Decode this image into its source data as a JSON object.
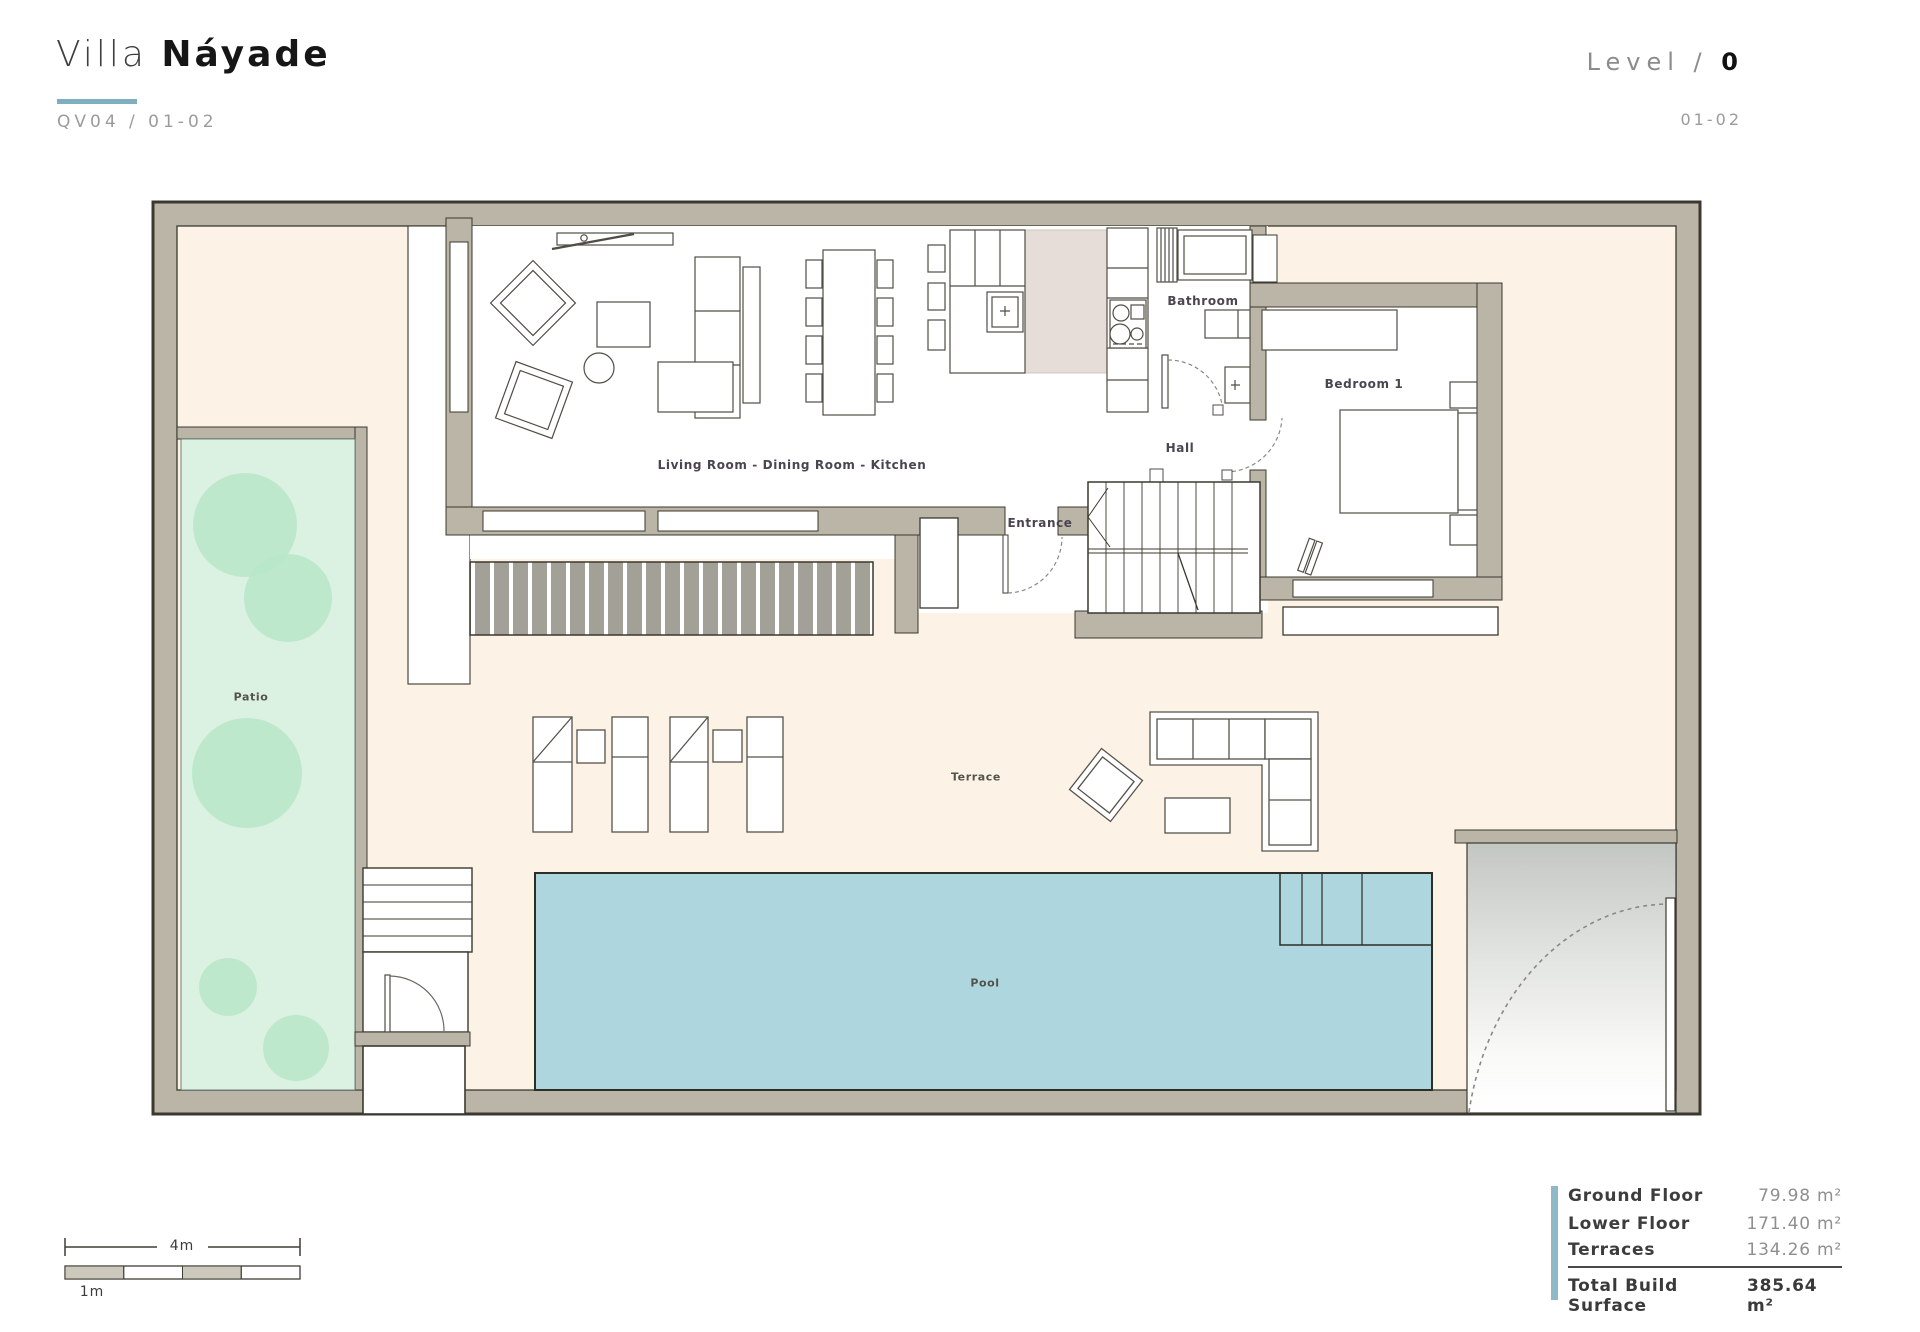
{
  "header": {
    "title_light": "Villa",
    "title_bold": "Náyade",
    "project_code": "QV04 / 01-02",
    "level_label": "Level /",
    "level_value": "0",
    "sheet_code": "01-02"
  },
  "plan": {
    "rooms": {
      "living": "Living Room - Dining Room - Kitchen",
      "bathroom": "Bathroom",
      "hall": "Hall",
      "bedroom": "Bedroom 1",
      "entrance": "Entrance",
      "patio": "Patio",
      "terrace": "Terrace",
      "pool": "Pool"
    }
  },
  "scale_bar": {
    "major": "4m",
    "minor": "1m"
  },
  "summary": {
    "rows": [
      {
        "label": "Ground Floor",
        "value": "79.98 m²"
      },
      {
        "label": "Lower Floor",
        "value": "171.40 m²"
      },
      {
        "label": "Terraces",
        "value": "134.26 m²"
      }
    ],
    "total": {
      "label": "Total Build Surface",
      "value": "385.64 m²"
    }
  },
  "colors": {
    "wall": "#bab5a6",
    "wall_outline": "#3b392f",
    "floor_cream": "#fcf3e6",
    "patio_green": "#dbf2e2",
    "tree_green": "#b9e6c8",
    "pool_blue": "#aed6df",
    "kitchen_floor": "#e6ddd8",
    "accent_teal": "#7fafbe",
    "label_text": "#4a4550"
  }
}
